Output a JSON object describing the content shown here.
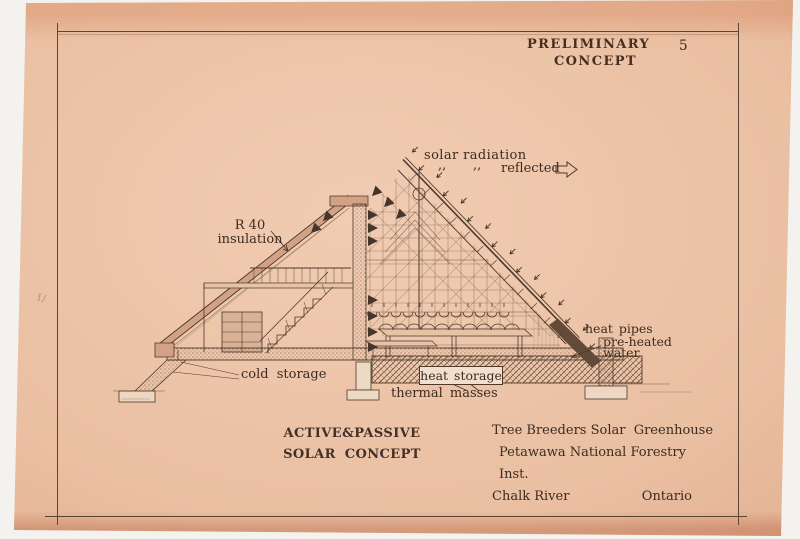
{
  "stamp": {
    "line1": "PRELIMINARY",
    "line2": "CONCEPT",
    "page_number": "5"
  },
  "labels": {
    "solar_radiation": "solar radiation",
    "ditto1": ",,",
    "ditto2": ",,",
    "reflected": "reflected",
    "r40": "R 40",
    "insulation": "insulation",
    "heat_pipes": "heat pipes",
    "pre_heated": "pre-heated",
    "water": "water",
    "cold_storage": "cold storage",
    "heat_storage": "heat storage",
    "thermal_masses": "thermal masses"
  },
  "footer": {
    "concept_line1": "ACTIVE&PASSIVE",
    "concept_line2": "SOLAR CONCEPT",
    "project_name": "Tree Breeders Solar  Greenhouse",
    "institute": "Petawawa National Forestry Inst.",
    "location_left": "Chalk River",
    "location_right": "Ontario"
  },
  "margin_mark": "1/",
  "colors": {
    "paper": "#eabfa2",
    "ink": "#4d392c",
    "text": "#3b2b20",
    "dark_band": "#634b39"
  }
}
